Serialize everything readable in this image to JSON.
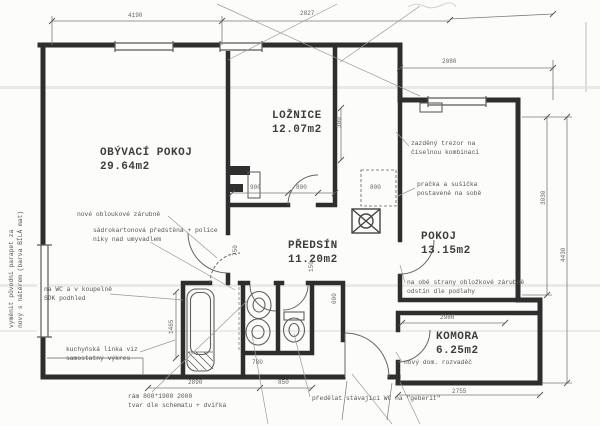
{
  "colors": {
    "paper": "#fcfcfa",
    "wall": "#2e2e2e",
    "thin_line": "#8a8a8a",
    "text": "#4a4a4a",
    "dim_text": "#666666"
  },
  "rooms": [
    {
      "name": "OBÝVACÍ POKOJ",
      "area": "29.64m2",
      "x": 100,
      "y": 147
    },
    {
      "name": "LOŽNICE",
      "area": "12.07m2",
      "x": 272,
      "y": 110
    },
    {
      "name": "PŘEDSÍN",
      "area": "11.20m2",
      "x": 288,
      "y": 240
    },
    {
      "name": "POKOJ",
      "area": "13.15m2",
      "x": 421,
      "y": 231
    },
    {
      "name": "KOMORA",
      "area": "6.25m2",
      "x": 436,
      "y": 331
    }
  ],
  "annotations": [
    {
      "lines": [
        "nové obloukové zárubně"
      ],
      "x": 77,
      "y": 211,
      "rot": 0
    },
    {
      "lines": [
        "sádrokartonová předstěna + police",
        "niky nad umyvadlem"
      ],
      "x": 93,
      "y": 227,
      "rot": 0
    },
    {
      "lines": [
        "na WC a v koupelně",
        "SDK podhled"
      ],
      "x": 44,
      "y": 286,
      "rot": 0
    },
    {
      "lines": [
        "kuchyňská linka viz",
        "samostatný výkres"
      ],
      "x": 66,
      "y": 346,
      "rot": 0
    },
    {
      "lines": [
        "zazděný trezor na",
        "číselnou kombinaci"
      ],
      "x": 411,
      "y": 140,
      "rot": 0
    },
    {
      "lines": [
        "pračka a sušička",
        "postavené na sobě"
      ],
      "x": 417,
      "y": 181,
      "rot": 0
    },
    {
      "lines": [
        "na obě strany obložkové zárubně",
        "odstín dle podlahy"
      ],
      "x": 407,
      "y": 279,
      "rot": 0
    },
    {
      "lines": [
        "nový dom. rozvaděč"
      ],
      "x": 404,
      "y": 359,
      "rot": 0
    },
    {
      "lines": [
        "předělat stávající WC na \"geberit\""
      ],
      "x": 312,
      "y": 395,
      "rot": 0
    },
    {
      "lines": [
        "rám 800*1900 2000",
        "tvar dle schematu + dvířka"
      ],
      "x": 128,
      "y": 393,
      "rot": 0
    },
    {
      "lines": [
        "vyměnit původní parapet za",
        "nový s nátěrem (barva BÍLÁ mat)"
      ],
      "x": 8,
      "y": 328,
      "rot": -90
    }
  ],
  "dims": [
    {
      "t": "4190",
      "x": 128,
      "y": 12,
      "rot": 0
    },
    {
      "t": "2827",
      "x": 300,
      "y": 10,
      "rot": 0
    },
    {
      "t": "2080",
      "x": 442,
      "y": 58,
      "rot": 0
    },
    {
      "t": "3030",
      "x": 540,
      "y": 205,
      "rot": -90
    },
    {
      "t": "4430",
      "x": 560,
      "y": 262,
      "rot": -90
    },
    {
      "t": "2890",
      "x": 188,
      "y": 379,
      "rot": 0
    },
    {
      "t": "850",
      "x": 278,
      "y": 379,
      "rot": 0
    },
    {
      "t": "2980",
      "x": 440,
      "y": 314,
      "rot": 0
    },
    {
      "t": "2755",
      "x": 452,
      "y": 388,
      "rot": 0
    },
    {
      "t": "1465",
      "x": 168,
      "y": 334,
      "rot": -90
    },
    {
      "t": "900",
      "x": 250,
      "y": 184,
      "rot": 0
    },
    {
      "t": "800",
      "x": 296,
      "y": 184,
      "rot": 0
    },
    {
      "t": "800",
      "x": 370,
      "y": 184,
      "rot": 0
    },
    {
      "t": "300",
      "x": 336,
      "y": 128,
      "rot": -90
    },
    {
      "t": "750",
      "x": 232,
      "y": 256,
      "rot": -90
    },
    {
      "t": "780",
      "x": 252,
      "y": 359,
      "rot": 0
    },
    {
      "t": "600",
      "x": 331,
      "y": 304,
      "rot": -90
    },
    {
      "t": "150",
      "x": 308,
      "y": 272,
      "rot": -90
    }
  ]
}
